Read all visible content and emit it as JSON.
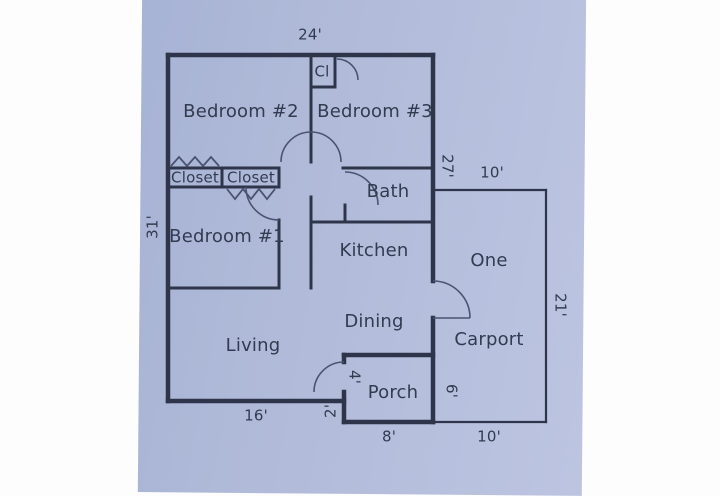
{
  "rooms": {
    "bedroom2": "Bedroom #2",
    "bedroom3": "Bedroom #3",
    "bedroom1": "Bedroom #1",
    "closet_small": "Cl",
    "closet_left": "Closet",
    "closet_right": "Closet",
    "bath": "Bath",
    "kitchen": "Kitchen",
    "living": "Living",
    "dining": "Dining",
    "porch": "Porch",
    "carport_word1": "One",
    "carport_word2": "Carport"
  },
  "dimensions": {
    "top_width": "24'",
    "left_height": "31'",
    "right_height": "27'",
    "carport_top_width": "10'",
    "carport_right_height": "21'",
    "carport_bottom_width": "10'",
    "carport_divider_height": "6'",
    "porch_bottom_width": "8'",
    "porch_depth": "4'",
    "step_depth": "2'",
    "living_bottom_width": "16'"
  },
  "colors": {
    "wall": "#2e354a",
    "paper": "#b4bedb",
    "text": "#333b50"
  }
}
